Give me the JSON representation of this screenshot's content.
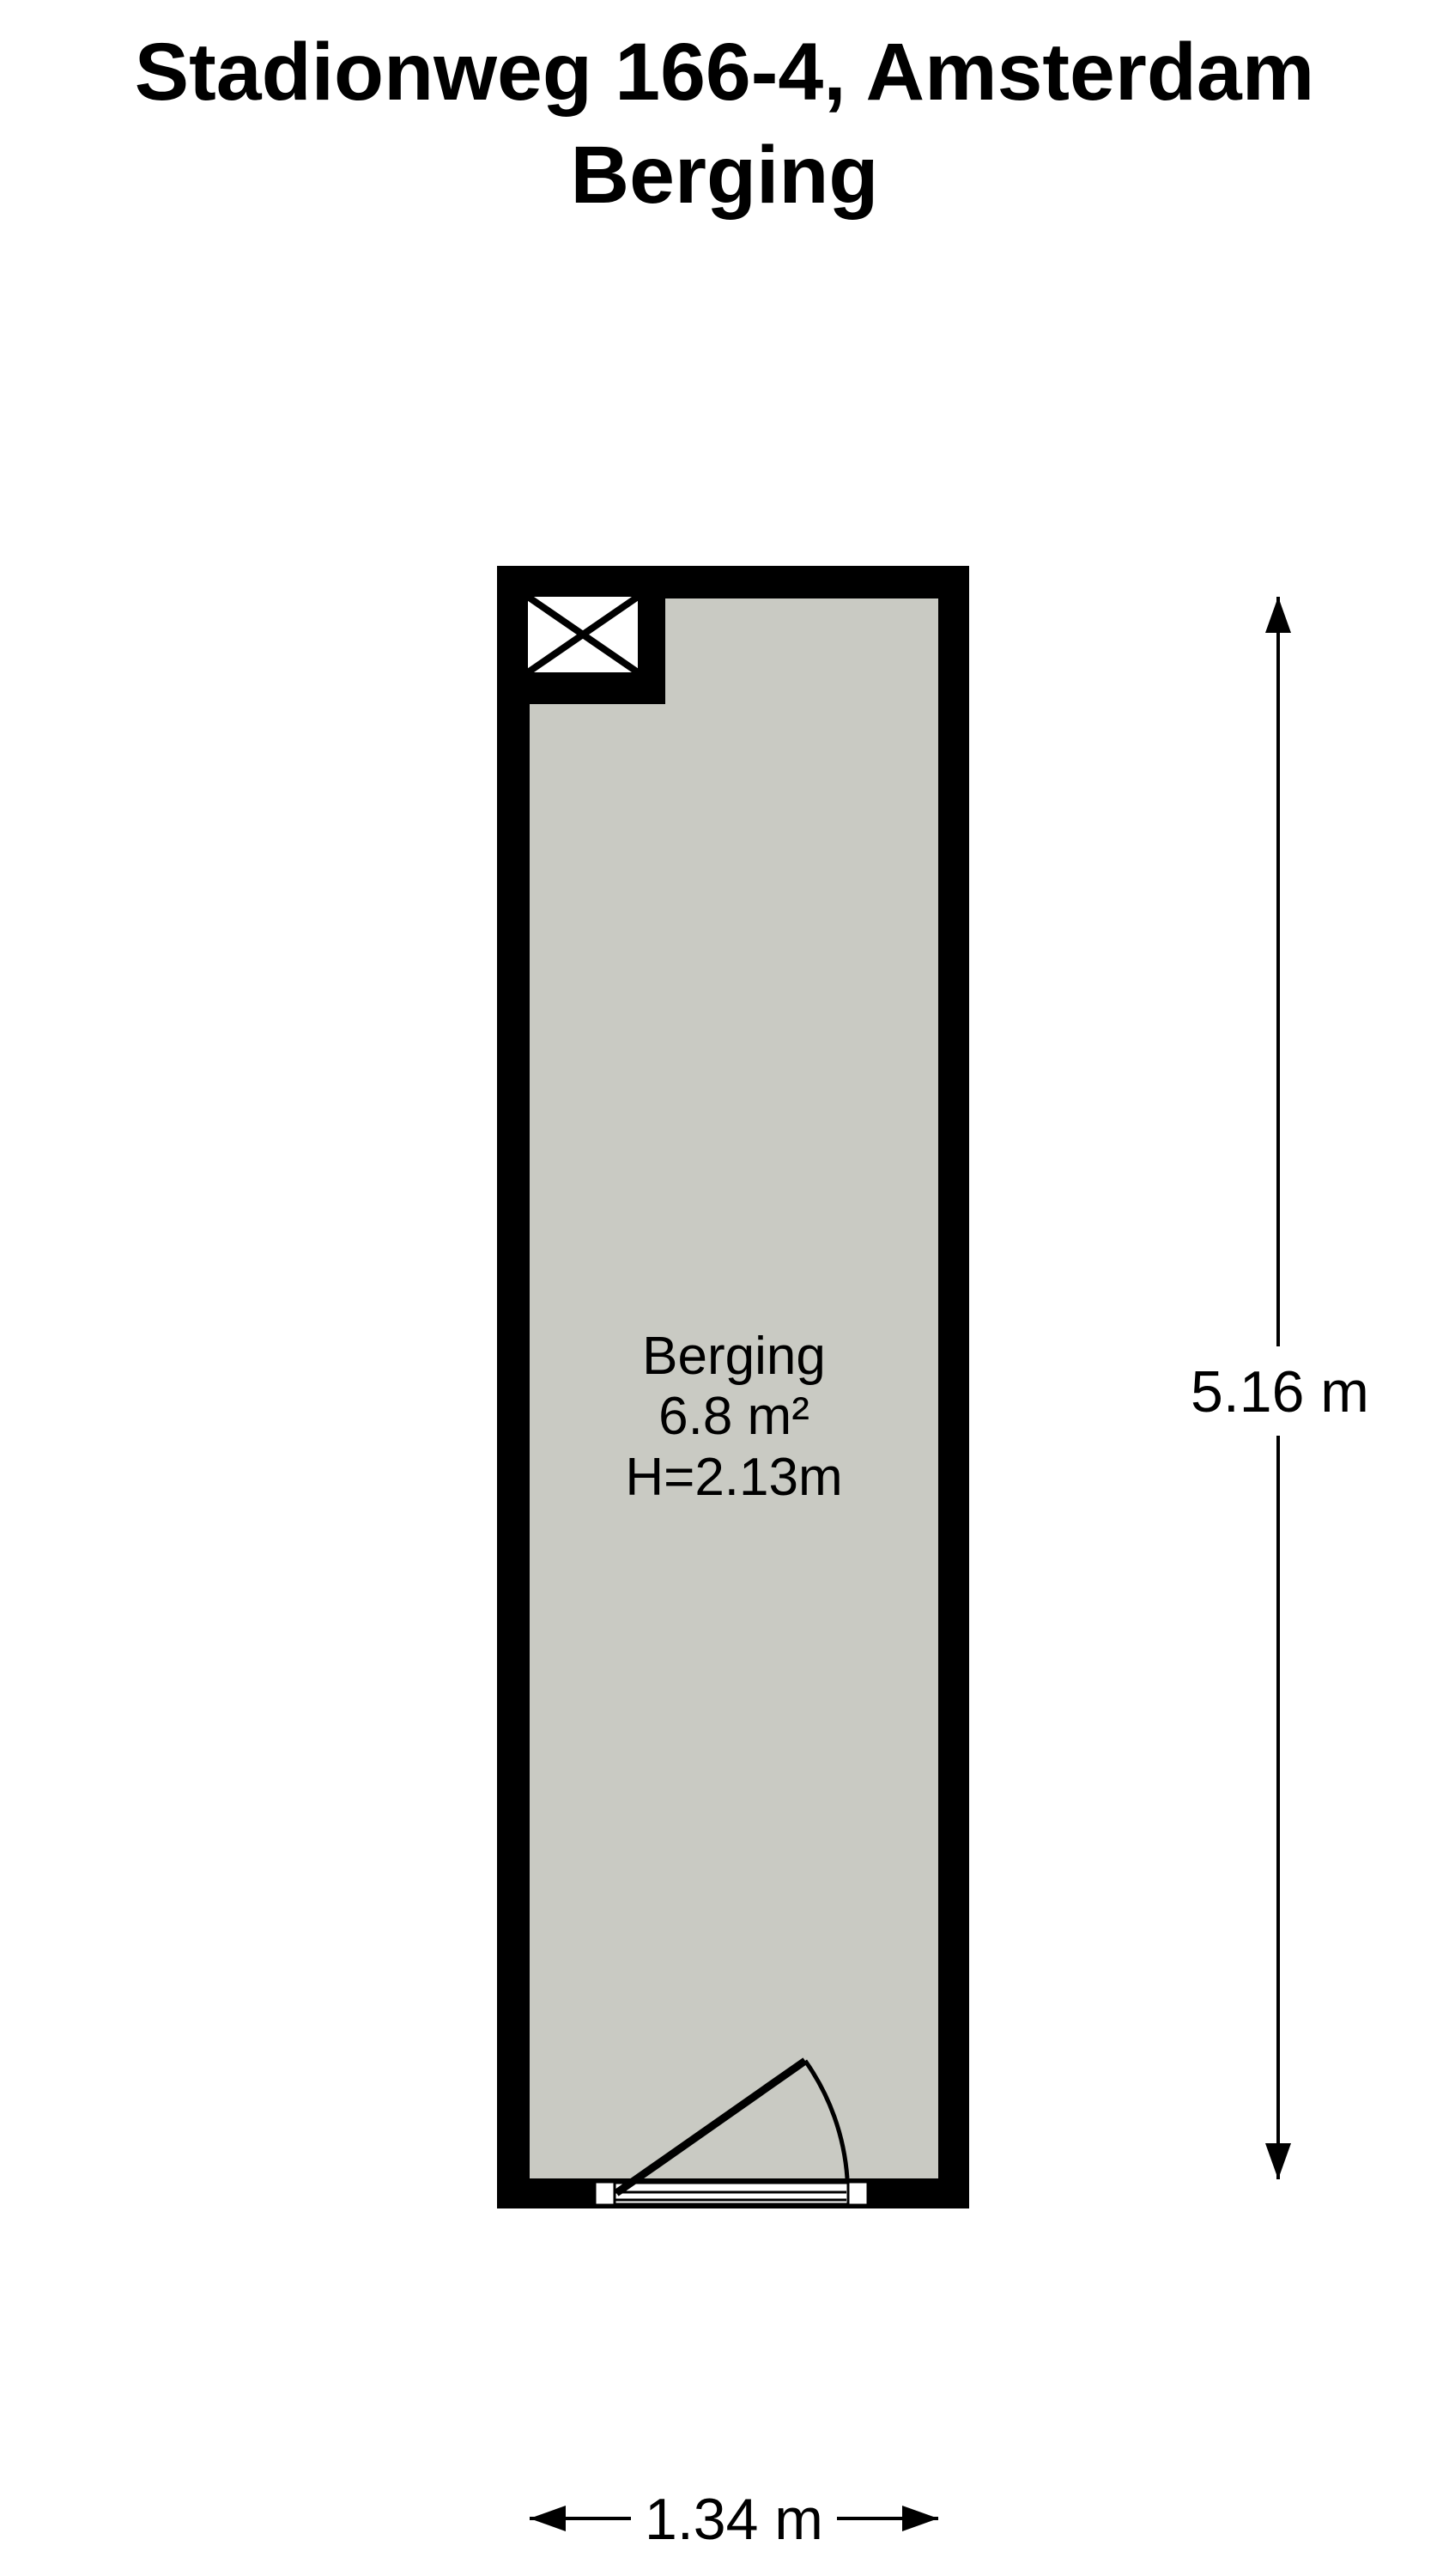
{
  "title": {
    "line1": "Stadionweg 166-4, Amsterdam",
    "line2": "Berging"
  },
  "room": {
    "name": "Berging",
    "area": "6.8 m²",
    "ceiling_height": "H=2.13m"
  },
  "dimensions": {
    "vertical": "5.16 m",
    "horizontal": "1.34 m"
  },
  "icons": {
    "shaft_symbol": "crossed-box"
  },
  "colors": {
    "wall": "#000000",
    "floor_fill": "#c9cac3",
    "background": "#ffffff",
    "text": "#000000"
  }
}
